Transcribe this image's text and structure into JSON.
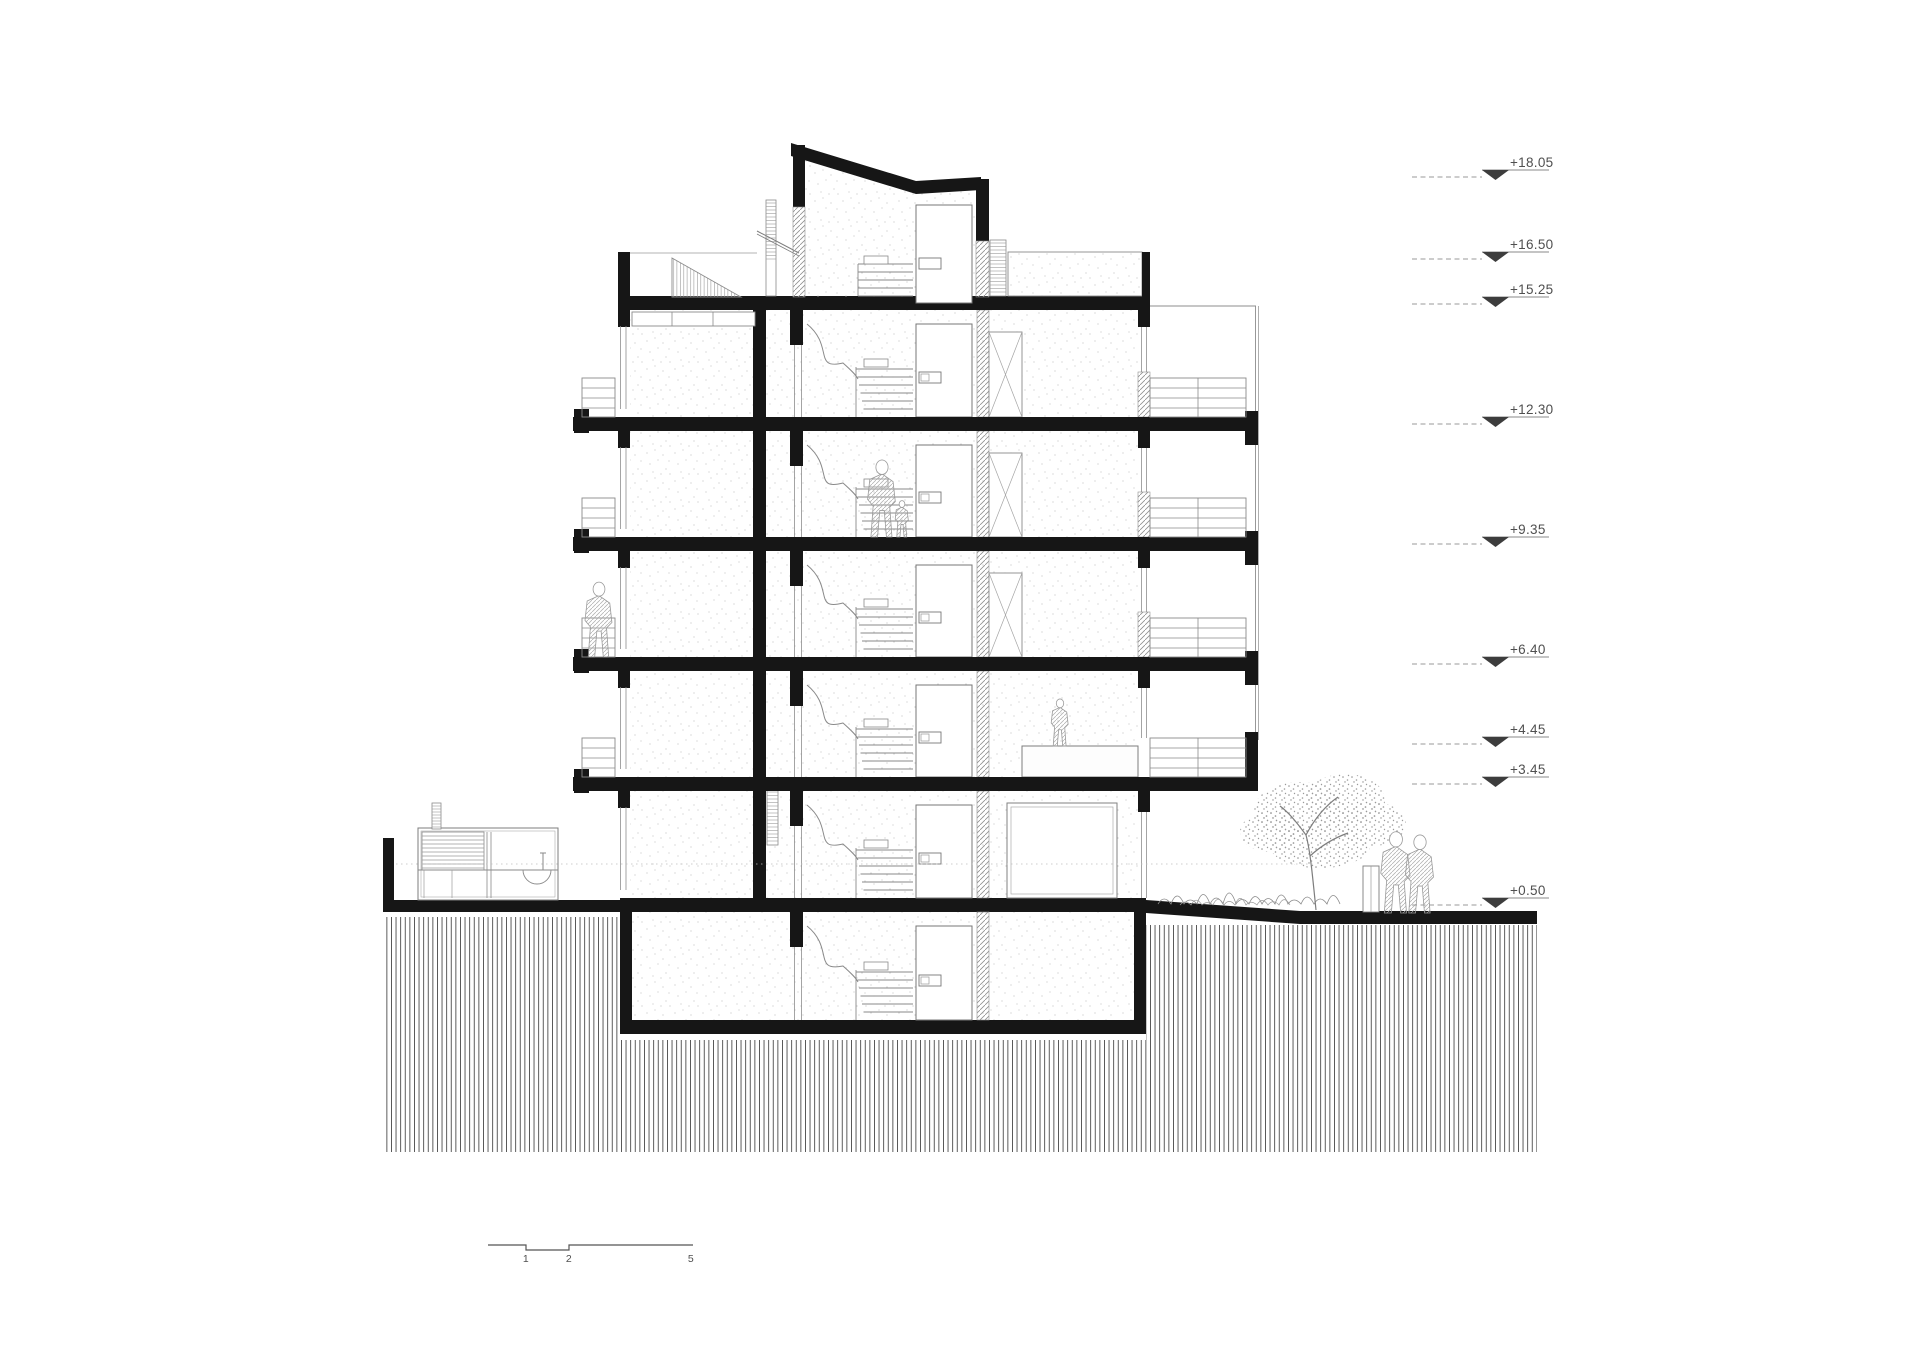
{
  "drawing": {
    "type": "building-cross-section",
    "level_markers": [
      {
        "label": "+18.05",
        "y": 170
      },
      {
        "label": "+16.50",
        "y": 252
      },
      {
        "label": "+15.25",
        "y": 297
      },
      {
        "label": "+12.30",
        "y": 417
      },
      {
        "label": "+9.35",
        "y": 537
      },
      {
        "label": "+6.40",
        "y": 657
      },
      {
        "label": "+4.45",
        "y": 737
      },
      {
        "label": "+3.45",
        "y": 777
      },
      {
        "label": "+0.50",
        "y": 898
      }
    ],
    "scale_bar": {
      "labels": [
        {
          "text": "1",
          "x": 526
        },
        {
          "text": "2",
          "x": 569
        },
        {
          "text": "5",
          "x": 691
        }
      ],
      "y": 1245,
      "x_start": 488,
      "x_end": 693,
      "notch_start": 526,
      "notch_end": 569,
      "notch_drop": 5
    },
    "colors": {
      "cut": "#161616",
      "line": "#7a7a7a",
      "light": "#a6a6a6",
      "hatch": "#4f4f4f",
      "text": "#4f4f4f",
      "background": "#ffffff"
    }
  }
}
